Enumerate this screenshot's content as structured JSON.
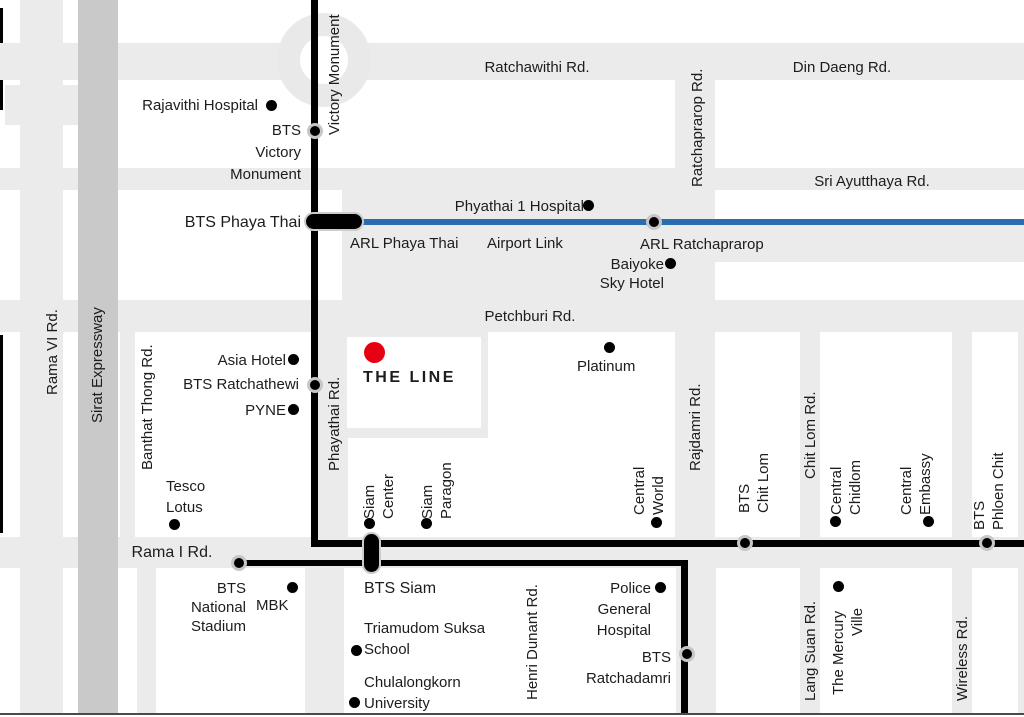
{
  "colors": {
    "road": "#ebebeb",
    "expressway": "#c9c9c9",
    "bts_line": "#000000",
    "arl_line": "#2b6cb0",
    "poi_dot": "#000000",
    "project_marker": "#e60012",
    "text": "#1c1c1c"
  },
  "roads": {
    "ratchawithi": "Ratchawithi Rd.",
    "din_daeng": "Din Daeng Rd.",
    "sri_ayutthaya": "Sri Ayutthaya Rd.",
    "petchburi": "Petchburi Rd.",
    "rama1": "Rama I Rd.",
    "rama6": "Rama VI Rd.",
    "sirat": "Sirat Expressway",
    "banthat": "Banthat Thong Rd.",
    "phayathai": "Phayathai Rd.",
    "victory": "Victory Monument",
    "ratchaprarop": "Ratchaprarop Rd.",
    "rajdamri": "Rajdamri Rd.",
    "chitlom": "Chit Lom Rd.",
    "langsuan": "Lang Suan Rd.",
    "wireless": "Wireless Rd.",
    "henri_dunant": "Henri Dunant Rd."
  },
  "stations": {
    "victory1": "BTS",
    "victory2": "Victory",
    "victory3": "Monument",
    "phayathai": "BTS Phaya Thai",
    "arl_phayathai": "ARL Phaya Thai",
    "airport_link": "Airport Link",
    "arl_ratchaprarop": "ARL Ratchaprarop",
    "ratchathewi": "BTS Ratchathewi",
    "siam": "BTS Siam",
    "national1": "BTS",
    "national2": "National",
    "national3": "Stadium",
    "chitlom1": "BTS",
    "chitlom2": "Chit Lom",
    "phloenchit1": "BTS",
    "phloenchit2": "Phloen Chit",
    "ratchadamri1": "BTS",
    "ratchadamri2": "Ratchadamri"
  },
  "pois": {
    "rajavithi": "Rajavithi Hospital",
    "phyathai_hospital": "Phyathai 1 Hospital",
    "baiyoke1": "Baiyoke",
    "baiyoke2": "Sky Hotel",
    "platinum": "Platinum",
    "asia": "Asia Hotel",
    "pyne": "PYNE",
    "tesco1": "Tesco",
    "tesco2": "Lotus",
    "mbk": "MBK",
    "triamudom1": "Triamudom Suksa",
    "triamudom2": "School",
    "chula1": "Chulalongkorn",
    "chula2": "University",
    "police1": "Police",
    "police2": "General",
    "police3": "Hospital",
    "central_world1": "Central",
    "central_world2": "World",
    "siam_center1": "Siam",
    "siam_center2": "Center",
    "siam_paragon1": "Siam",
    "siam_paragon2": "Paragon",
    "central_chidlom1": "Central",
    "central_chidlom2": "Chidlom",
    "central_embassy1": "Central",
    "central_embassy2": "Embassy",
    "mercury1": "The Mercury",
    "mercury2": "Ville"
  },
  "project": {
    "name": "THE LINE"
  }
}
